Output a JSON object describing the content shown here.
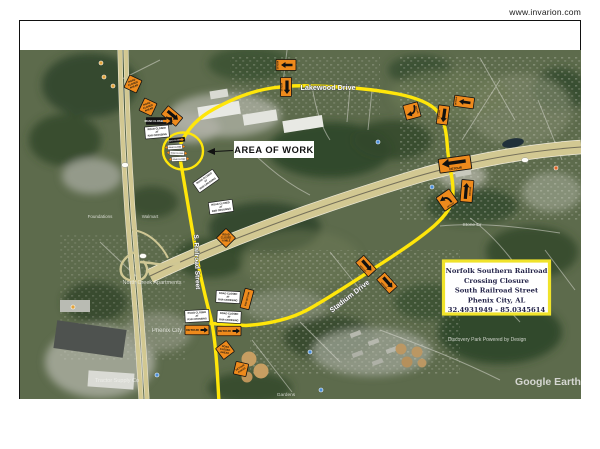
{
  "header": {
    "website": "www.invarion.com"
  },
  "map": {
    "area_of_work_label": "AREA OF WORK",
    "streets": {
      "lakewood": "Lakewood Drive",
      "railroad": "S. Railroad Street",
      "stadium": "Stadium Drive"
    },
    "info_box": {
      "line1": "Norfolk Southern Railroad",
      "line2": "Crossing Closure",
      "line3": "South Railroad Street",
      "line4": "Phenix City, AL",
      "line5": "32.4931949 - 85.0345614"
    },
    "watermarks": {
      "google": "Google Earth",
      "attribution": "Discovery Park Powered by Design"
    },
    "poi_labels": {
      "north_creek": "North Creek Apartments",
      "phenix": "Phenix City",
      "tractor": "Tractor Supply Co",
      "stone": "Stone Dr",
      "gardens": "Gardens",
      "foundations": "Foundations",
      "walmart": "Walmart"
    }
  },
  "signs": {
    "detour": "DETOUR",
    "end_detour": "END DETOUR",
    "road_closed": "ROAD CLOSED",
    "rxr_l1": "ROAD CLOSED",
    "rxr_l2": "AT",
    "rxr_l3": "RXR CROSSING",
    "ahead_l1": "ROAD",
    "ahead_l2": "CLOSED",
    "ahead_l3": "AHEAD",
    "half_l1": "ROAD",
    "half_l2": "CLOSED",
    "half_l3": "½ MILE",
    "da_l1": "DETOUR",
    "da_l2": "AHEAD"
  },
  "colors": {
    "route_yellow": "#ffe60a",
    "sign_orange": "#ee8a1c",
    "info_border": "#f0e32a"
  }
}
